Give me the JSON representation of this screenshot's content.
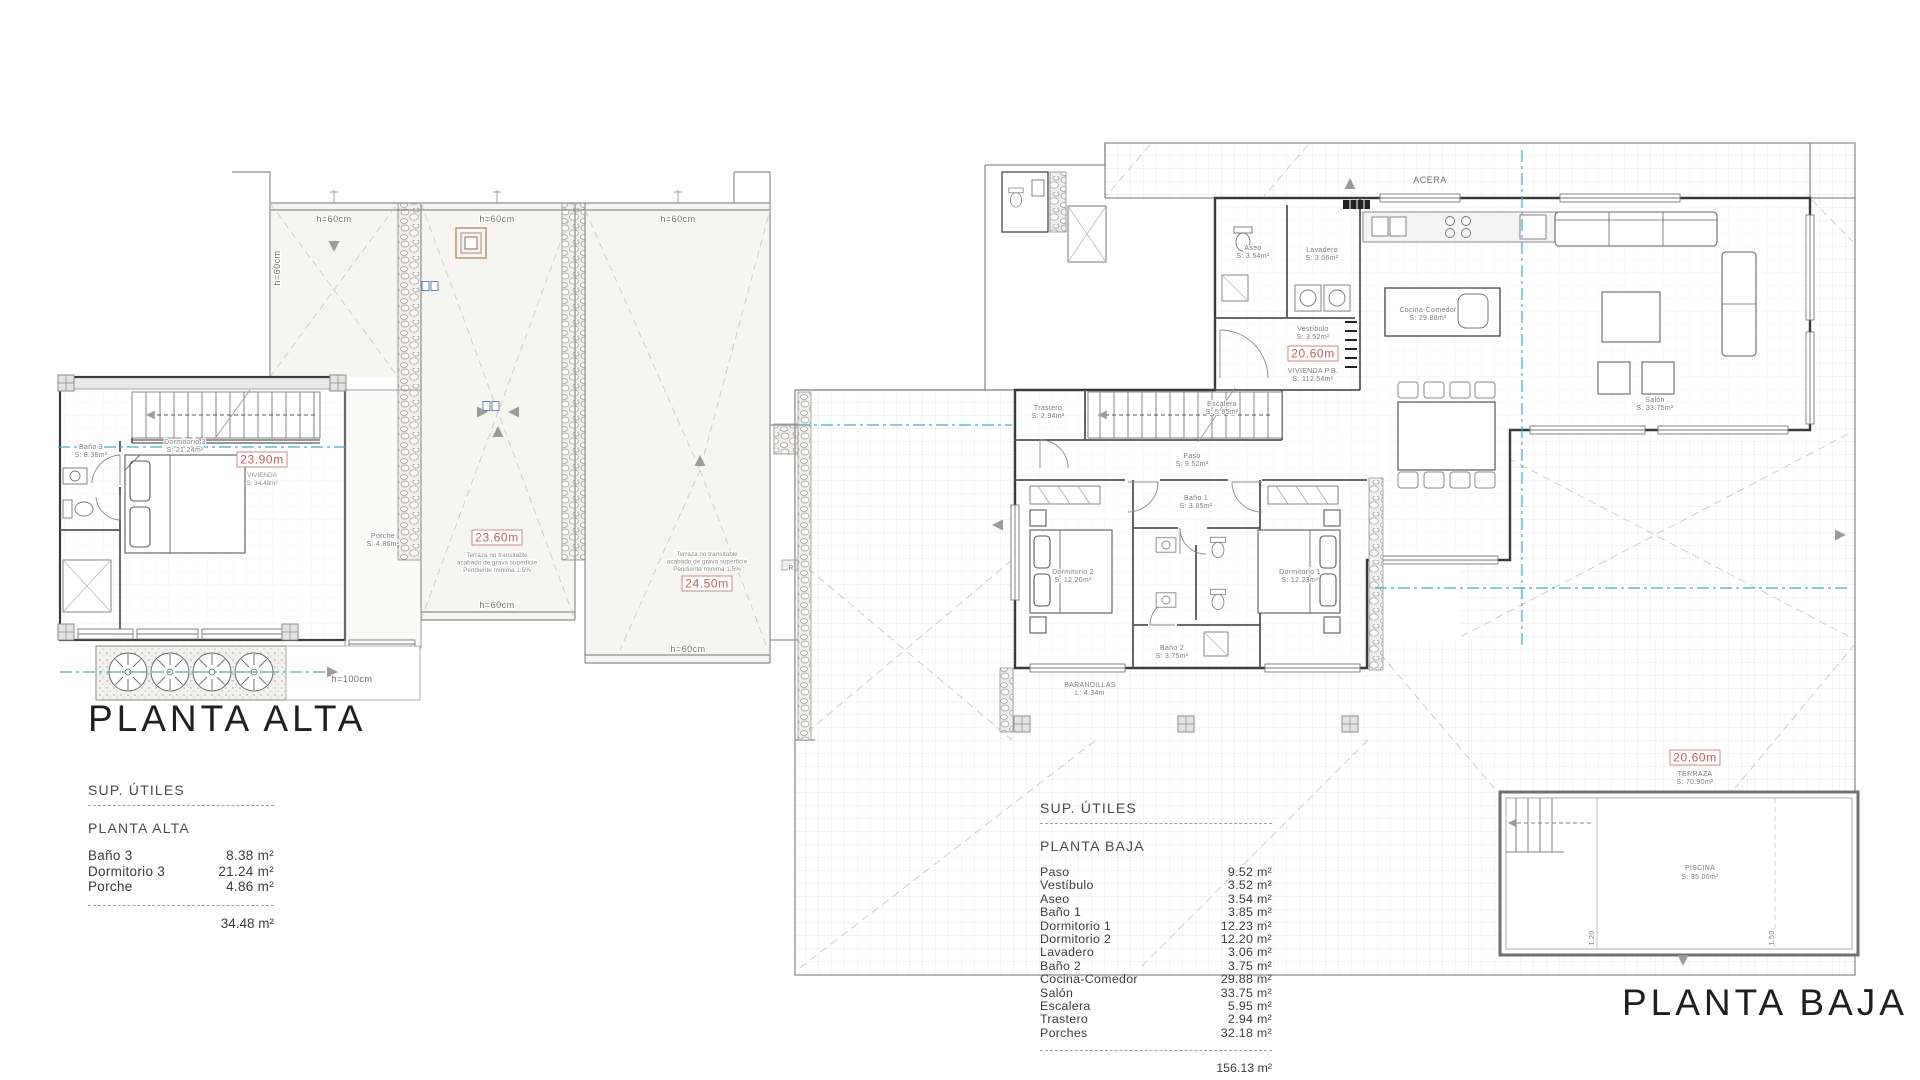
{
  "colors": {
    "accent_red": "#c0605a",
    "section_teal": "#4aa9bd",
    "wall": "#3a3a3a"
  },
  "plan_alta": {
    "title": "PLANTA ALTA",
    "height_top_left": "h=60cm",
    "height_top_mid": "h=60cm",
    "height_top_right": "h=60cm",
    "height_left": "h=60cm",
    "height_mid_bottom": "h=60cm",
    "height_right_bottom": "h=60cm",
    "height_porch": "h=100cm",
    "level_vivienda": "23.90m",
    "vivienda_label": "VIVIENDA",
    "vivienda_area": "S: 34.48m²",
    "level_roof_mid": "23.60m",
    "level_roof_right": "24.50m",
    "roof_note_1": "Terraza no transitable",
    "roof_note_2": "acabado de grava superficie",
    "roof_note_3": "Pendiente mínima 1.5%",
    "r_marker": "R",
    "rooms": {
      "dormitorio3": {
        "name": "Dormitorio 3",
        "area": "S: 21.24m²"
      },
      "bano3": {
        "name": "Baño 3",
        "area": "S: 8.38m²"
      },
      "porche": {
        "name": "Porche",
        "area": "S: 4.86m²"
      }
    }
  },
  "plan_baja": {
    "title": "PLANTA BAJA",
    "acera_label": "ACERA",
    "level_vivienda": "20.60m",
    "vivienda_label": "VIVIENDA P.B.",
    "vivienda_area": "S: 112.54m²",
    "level_terraza": "20.60m",
    "terraza_label": "TERRAZA",
    "terraza_area": "S: 70.90m²",
    "piscina_label": "PISCINA",
    "piscina_area": "S: 35.00m²",
    "pool_depth_1": "1.20",
    "pool_depth_2": "1.50",
    "barandilla_1": "BARANDILLAS",
    "barandilla_2": "L: 4.34m",
    "rooms": {
      "paso": {
        "name": "Paso",
        "area": "S: 9.52m²"
      },
      "vestibulo": {
        "name": "Vestíbulo",
        "area": "S: 3.52m²"
      },
      "aseo": {
        "name": "Aseo",
        "area": "S: 3.54m²"
      },
      "bano1": {
        "name": "Baño 1",
        "area": "S: 3.85m²"
      },
      "dorm1": {
        "name": "Dormitorio 1",
        "area": "S: 12.23m²"
      },
      "dorm2": {
        "name": "Dormitorio 2",
        "area": "S: 12.20m²"
      },
      "lavadero": {
        "name": "Lavadero",
        "area": "S: 3.06m²"
      },
      "bano2": {
        "name": "Baño 2",
        "area": "S: 3.75m²"
      },
      "cocina": {
        "name": "Cocina-Comedor",
        "area": "S: 29.88m²"
      },
      "salon": {
        "name": "Salón",
        "area": "S: 33.75m²"
      },
      "escalera": {
        "name": "Escalera",
        "area": "S: 5.95m²"
      },
      "trastero": {
        "name": "Trastero",
        "area": "S: 2.94m²"
      }
    }
  },
  "tables": {
    "alta": {
      "header": "SUP. ÚTILES",
      "subheader": "PLANTA ALTA",
      "rows": [
        [
          "Baño 3",
          "8.38 m²"
        ],
        [
          "Dormitorio 3",
          "21.24 m²"
        ],
        [
          "Porche",
          "4.86 m²"
        ]
      ],
      "total": "34.48 m²"
    },
    "baja": {
      "header": "SUP. ÚTILES",
      "subheader": "PLANTA BAJA",
      "rows": [
        [
          "Paso",
          "9.52 m²"
        ],
        [
          "Vestíbulo",
          "3.52 m²"
        ],
        [
          "Aseo",
          "3.54 m²"
        ],
        [
          "Baño 1",
          "3.85 m²"
        ],
        [
          "Dormitorio 1",
          "12.23 m²"
        ],
        [
          "Dormitorio 2",
          "12.20 m²"
        ],
        [
          "Lavadero",
          "3.06 m²"
        ],
        [
          "Baño 2",
          "3.75 m²"
        ],
        [
          "Cocina-Comedor",
          "29.88 m²"
        ],
        [
          "Salón",
          "33.75 m²"
        ],
        [
          "Escalera",
          "5.95 m²"
        ],
        [
          "Trastero",
          "2.94 m²"
        ],
        [
          "Porches",
          "32.18 m²"
        ]
      ],
      "total": "156.13 m²"
    }
  }
}
